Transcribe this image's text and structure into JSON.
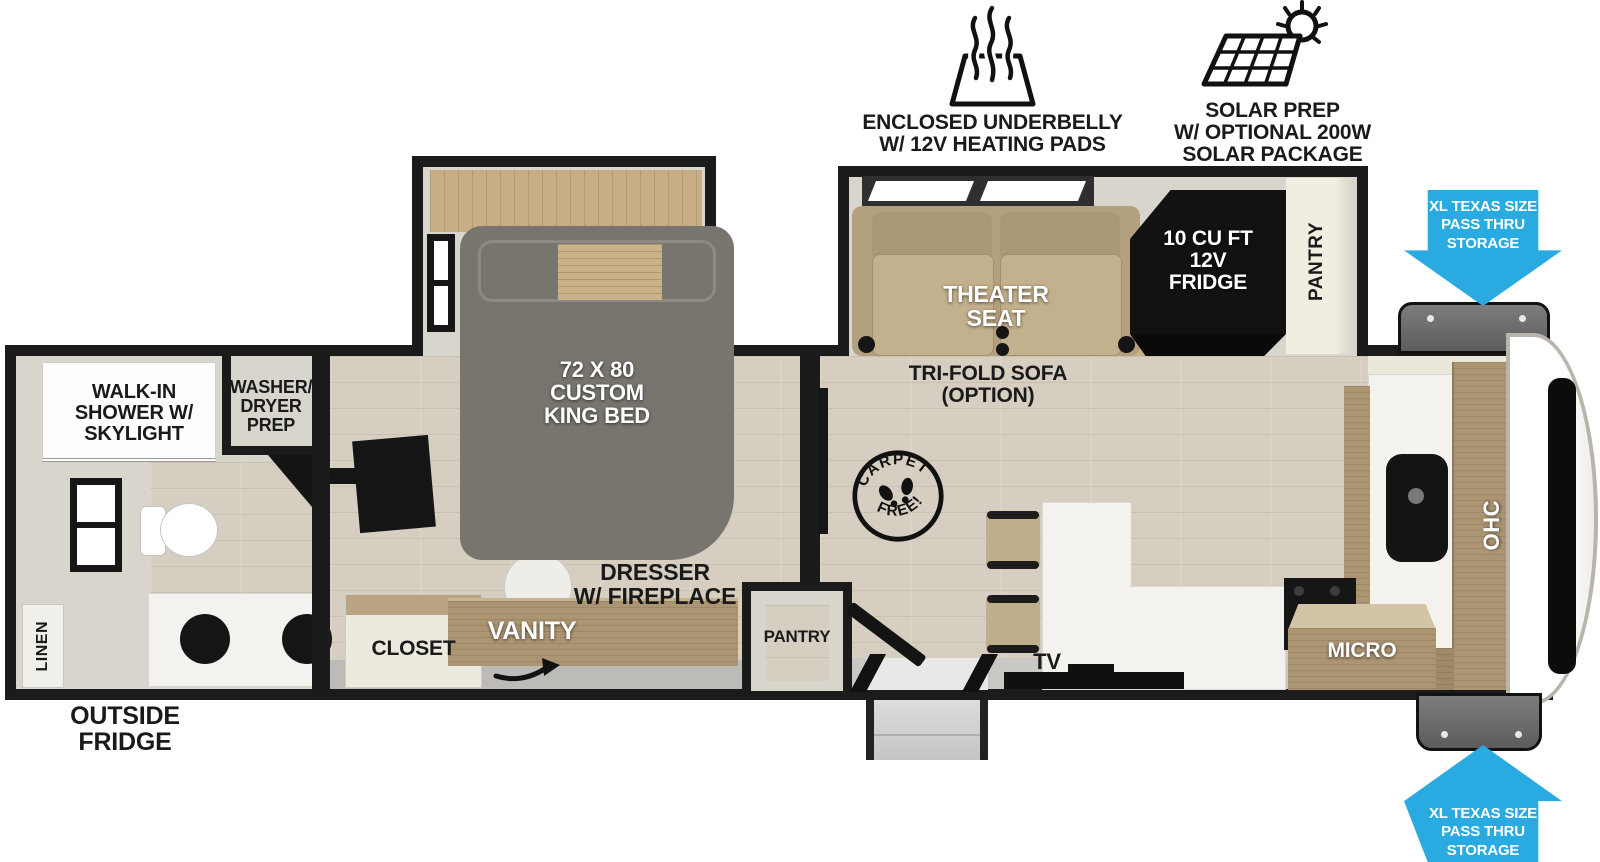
{
  "title": "Travel trailer floor plan",
  "colors": {
    "accent_blue": "#29ABE2",
    "wall_black": "#1b1b1b",
    "bed_gray": "#78756F",
    "seat_tan": "#C3B08C",
    "cabinet_wood": "#AC9573",
    "floor_wood": "#D6CFC1"
  },
  "features": {
    "underbelly": {
      "label": "ENCLOSED UNDERBELLY\nW/ 12V HEATING PADS",
      "icon": "heating-pads-icon"
    },
    "solar": {
      "label": "SOLAR PREP\nW/ OPTIONAL 200W\nSOLAR PACKAGE",
      "icon": "solar-panel-icon"
    }
  },
  "storage": {
    "top": {
      "label": "XL TEXAS SIZE\nPASS THRU\nSTORAGE"
    },
    "bottom": {
      "label": "XL TEXAS SIZE\nPASS THRU\nSTORAGE"
    }
  },
  "bathroom": {
    "shower": "WALK-IN\nSHOWER W/\nSKYLIGHT",
    "washer_dryer": "WASHER/\nDRYER\nPREP",
    "linen": "LINEN",
    "outside_fridge": "OUTSIDE\nFRIDGE"
  },
  "bedroom": {
    "bed": "72 X 80\nCUSTOM\nKING BED",
    "closet": "CLOSET",
    "vanity": "VANITY",
    "dresser": "DRESSER\nW/ FIREPLACE",
    "pantry": "PANTRY"
  },
  "living": {
    "theater_seat": "THEATER\nSEAT",
    "sofa_option": "TRI-FOLD SOFA\n(OPTION)",
    "fridge": "10 CU FT\n12V\nFRIDGE",
    "pantry": "PANTRY",
    "carpet_free": {
      "top": "CARPET",
      "bottom": "FREE!"
    },
    "tv": "TV",
    "micro": "MICRO",
    "ohc": "OHC"
  }
}
